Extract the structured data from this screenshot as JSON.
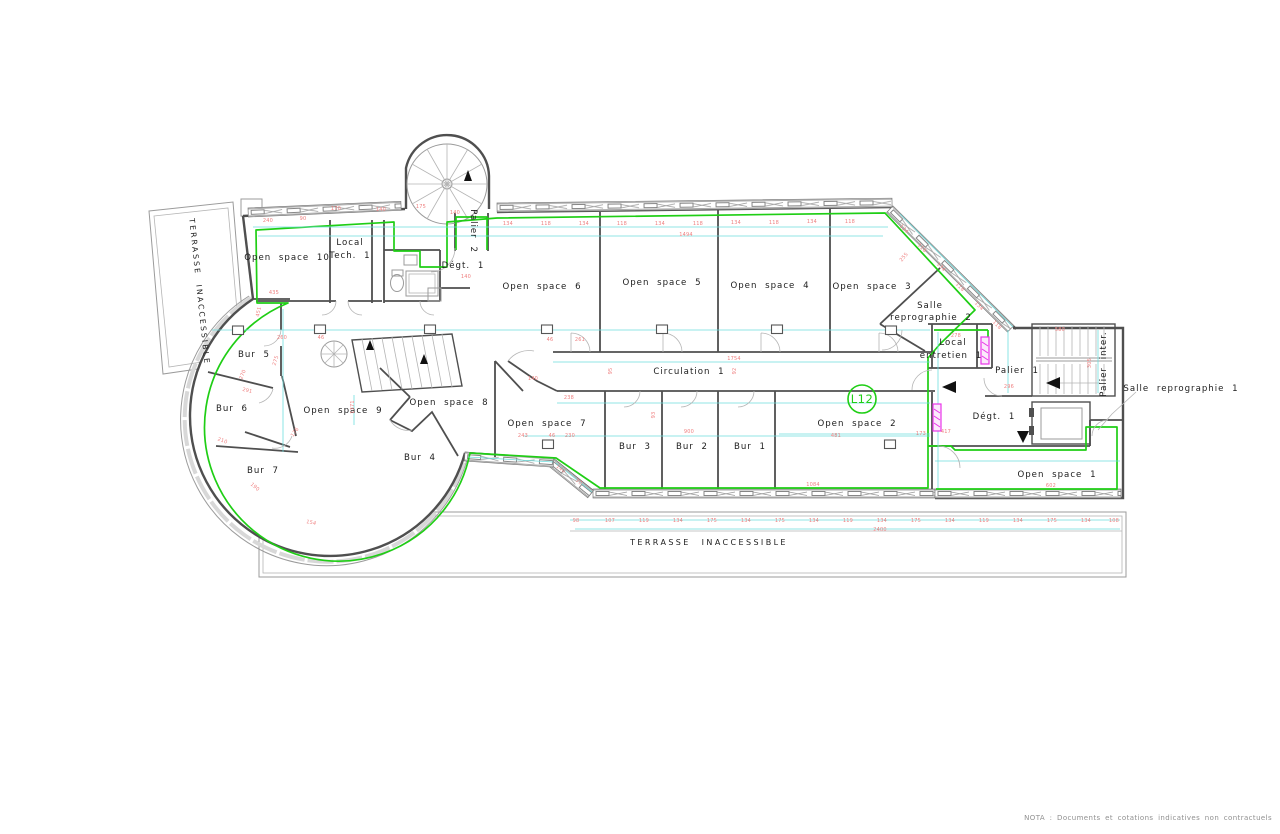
{
  "nota": "NOTA : Documents et cotations indicatives non contractuels",
  "colors": {
    "walls": "#4f4f4f",
    "perimeter_green": "#1fce15",
    "dimension_lines": "#6fdede",
    "dimension_text": "#ef8080",
    "ducts_magenta": "#e935e9"
  },
  "drawing_badge": {
    "label": "L12"
  },
  "labels": [
    {
      "id": "open-space-10",
      "t": "Open space 10",
      "x": 287,
      "y": 260
    },
    {
      "id": "local-tech-1-line1",
      "t": "Local",
      "x": 350,
      "y": 245
    },
    {
      "id": "local-tech-1-line2",
      "t": "Tech. 1",
      "x": 350,
      "y": 258
    },
    {
      "id": "degagement-2",
      "t": "Dégt. 1",
      "x": 463,
      "y": 268
    },
    {
      "id": "palier-2",
      "t": "Palier 2",
      "x": 471,
      "y": 231,
      "rot": 90
    },
    {
      "id": "open-space-6",
      "t": "Open space 6",
      "x": 542,
      "y": 289
    },
    {
      "id": "open-space-5",
      "t": "Open space 5",
      "x": 662,
      "y": 285
    },
    {
      "id": "open-space-4",
      "t": "Open space 4",
      "x": 770,
      "y": 288
    },
    {
      "id": "open-space-3",
      "t": "Open space 3",
      "x": 872,
      "y": 289
    },
    {
      "id": "salle-reprographie-2-line1",
      "t": "Salle",
      "x": 930,
      "y": 308
    },
    {
      "id": "salle-reprographie-2-line2",
      "t": "reprographie 2",
      "x": 931,
      "y": 320
    },
    {
      "id": "local-entretien-1-line1",
      "t": "Local",
      "x": 953,
      "y": 345
    },
    {
      "id": "local-entretien-1-line2",
      "t": "entretien 1",
      "x": 951,
      "y": 358
    },
    {
      "id": "palier-1",
      "t": "Palier 1",
      "x": 1017,
      "y": 373
    },
    {
      "id": "palier-inter",
      "t": "Palier inter.",
      "x": 1106,
      "y": 364,
      "rot": -90
    },
    {
      "id": "circulation-1",
      "t": "Circulation 1",
      "x": 689,
      "y": 374
    },
    {
      "id": "degagement-1",
      "t": "Dégt. 1",
      "x": 994,
      "y": 419
    },
    {
      "id": "open-space-2",
      "t": "Open space 2",
      "x": 857,
      "y": 426
    },
    {
      "id": "open-space-1",
      "t": "Open space 1",
      "x": 1057,
      "y": 477
    },
    {
      "id": "open-space-9",
      "t": "Open space 9",
      "x": 343,
      "y": 413
    },
    {
      "id": "open-space-8",
      "t": "Open space 8",
      "x": 449,
      "y": 405
    },
    {
      "id": "open-space-7",
      "t": "Open space 7",
      "x": 547,
      "y": 426
    },
    {
      "id": "bur-5",
      "t": "Bur 5",
      "x": 254,
      "y": 357
    },
    {
      "id": "bur-6",
      "t": "Bur 6",
      "x": 232,
      "y": 411
    },
    {
      "id": "bur-7",
      "t": "Bur 7",
      "x": 263,
      "y": 473
    },
    {
      "id": "bur-4",
      "t": "Bur 4",
      "x": 420,
      "y": 460
    },
    {
      "id": "bur-3",
      "t": "Bur 3",
      "x": 635,
      "y": 449
    },
    {
      "id": "bur-2",
      "t": "Bur 2",
      "x": 692,
      "y": 449
    },
    {
      "id": "bur-1",
      "t": "Bur 1",
      "x": 750,
      "y": 449
    },
    {
      "id": "terrasse-inaccessible-left",
      "t": "TERRASSE INACCESSIBLE",
      "x": 197,
      "y": 292,
      "rot": 84,
      "cls": "lbl-terr"
    },
    {
      "id": "terrasse-inaccessible-bottom",
      "t": "TERRASSE INACCESSIBLE",
      "x": 709,
      "y": 545,
      "cls": "lbl-terr2"
    },
    {
      "id": "salle-reprographie-1",
      "t": "Salle reprographie 1",
      "x": 1181,
      "y": 391
    },
    {
      "id": "l12-badge",
      "t": "L12",
      "x": 862,
      "y": 403,
      "cls": "lbl-badge"
    }
  ],
  "dims": [
    {
      "t": "134",
      "x": 508,
      "y": 225
    },
    {
      "t": "118",
      "x": 546,
      "y": 225
    },
    {
      "t": "134",
      "x": 584,
      "y": 225
    },
    {
      "t": "118",
      "x": 622,
      "y": 225
    },
    {
      "t": "134",
      "x": 660,
      "y": 225
    },
    {
      "t": "118",
      "x": 698,
      "y": 225
    },
    {
      "t": "134",
      "x": 736,
      "y": 224
    },
    {
      "t": "118",
      "x": 774,
      "y": 224
    },
    {
      "t": "134",
      "x": 812,
      "y": 223
    },
    {
      "t": "118",
      "x": 850,
      "y": 223
    },
    {
      "t": "240",
      "x": 268,
      "y": 222
    },
    {
      "t": "90",
      "x": 303,
      "y": 220
    },
    {
      "t": "170",
      "x": 336,
      "y": 210
    },
    {
      "t": "140",
      "x": 381,
      "y": 211
    },
    {
      "t": "175",
      "x": 421,
      "y": 208
    },
    {
      "t": "140",
      "x": 455,
      "y": 214
    },
    {
      "t": "134",
      "x": 903,
      "y": 230,
      "rot": 45
    },
    {
      "t": "118",
      "x": 921,
      "y": 249,
      "rot": 45
    },
    {
      "t": "134",
      "x": 940,
      "y": 268,
      "rot": 45
    },
    {
      "t": "118",
      "x": 959,
      "y": 288,
      "rot": 45
    },
    {
      "t": "134",
      "x": 978,
      "y": 307,
      "rot": 45
    },
    {
      "t": "118",
      "x": 996,
      "y": 326,
      "rot": 45
    },
    {
      "t": "98",
      "x": 576,
      "y": 522
    },
    {
      "t": "107",
      "x": 610,
      "y": 522
    },
    {
      "t": "119",
      "x": 644,
      "y": 522
    },
    {
      "t": "134",
      "x": 678,
      "y": 522
    },
    {
      "t": "175",
      "x": 712,
      "y": 522
    },
    {
      "t": "134",
      "x": 746,
      "y": 522
    },
    {
      "t": "175",
      "x": 780,
      "y": 522
    },
    {
      "t": "134",
      "x": 814,
      "y": 522
    },
    {
      "t": "119",
      "x": 848,
      "y": 522
    },
    {
      "t": "134",
      "x": 882,
      "y": 522
    },
    {
      "t": "175",
      "x": 916,
      "y": 522
    },
    {
      "t": "134",
      "x": 950,
      "y": 522
    },
    {
      "t": "119",
      "x": 984,
      "y": 522
    },
    {
      "t": "134",
      "x": 1018,
      "y": 522
    },
    {
      "t": "175",
      "x": 1052,
      "y": 522
    },
    {
      "t": "134",
      "x": 1086,
      "y": 522
    },
    {
      "t": "108",
      "x": 1114,
      "y": 522
    },
    {
      "t": "2400",
      "x": 880,
      "y": 531
    },
    {
      "t": "46",
      "x": 550,
      "y": 341
    },
    {
      "t": "261",
      "x": 580,
      "y": 341
    },
    {
      "t": "260",
      "x": 282,
      "y": 339
    },
    {
      "t": "46",
      "x": 321,
      "y": 339
    },
    {
      "t": "1494",
      "x": 686,
      "y": 236
    },
    {
      "t": "1754",
      "x": 734,
      "y": 360
    },
    {
      "t": "238",
      "x": 569,
      "y": 399
    },
    {
      "t": "140",
      "x": 533,
      "y": 380
    },
    {
      "t": "243",
      "x": 523,
      "y": 437
    },
    {
      "t": "46",
      "x": 552,
      "y": 437
    },
    {
      "t": "230",
      "x": 570,
      "y": 437
    },
    {
      "t": "900",
      "x": 689,
      "y": 433
    },
    {
      "t": "95",
      "x": 612,
      "y": 371,
      "rot": -90
    },
    {
      "t": "92",
      "x": 736,
      "y": 371,
      "rot": -90
    },
    {
      "t": "93",
      "x": 655,
      "y": 415,
      "rot": -90
    },
    {
      "t": "481",
      "x": 836,
      "y": 437
    },
    {
      "t": "1084",
      "x": 813,
      "y": 486
    },
    {
      "t": "417",
      "x": 946,
      "y": 433
    },
    {
      "t": "173",
      "x": 921,
      "y": 435
    },
    {
      "t": "296",
      "x": 1009,
      "y": 388
    },
    {
      "t": "278",
      "x": 956,
      "y": 337
    },
    {
      "t": "602",
      "x": 1051,
      "y": 487
    },
    {
      "t": "580",
      "x": 1060,
      "y": 331
    },
    {
      "t": "305",
      "x": 1091,
      "y": 363,
      "rot": -90
    },
    {
      "t": "140",
      "x": 466,
      "y": 278
    },
    {
      "t": "435",
      "x": 274,
      "y": 294
    },
    {
      "t": "451",
      "x": 260,
      "y": 312,
      "rot": -78
    },
    {
      "t": "275",
      "x": 277,
      "y": 361,
      "rot": -72
    },
    {
      "t": "270",
      "x": 244,
      "y": 375,
      "rot": -68
    },
    {
      "t": "291",
      "x": 247,
      "y": 392,
      "rot": 14
    },
    {
      "t": "210",
      "x": 222,
      "y": 442,
      "rot": 20
    },
    {
      "t": "176",
      "x": 296,
      "y": 433,
      "rot": -55
    },
    {
      "t": "190",
      "x": 254,
      "y": 488,
      "rot": 40
    },
    {
      "t": "154",
      "x": 311,
      "y": 524,
      "rot": 12
    },
    {
      "t": "1371",
      "x": 354,
      "y": 407,
      "rot": -90
    },
    {
      "t": "140",
      "x": 560,
      "y": 470,
      "rot": 38
    },
    {
      "t": "90",
      "x": 578,
      "y": 483,
      "rot": 38
    },
    {
      "t": "255",
      "x": 905,
      "y": 258,
      "rot": -50
    }
  ]
}
